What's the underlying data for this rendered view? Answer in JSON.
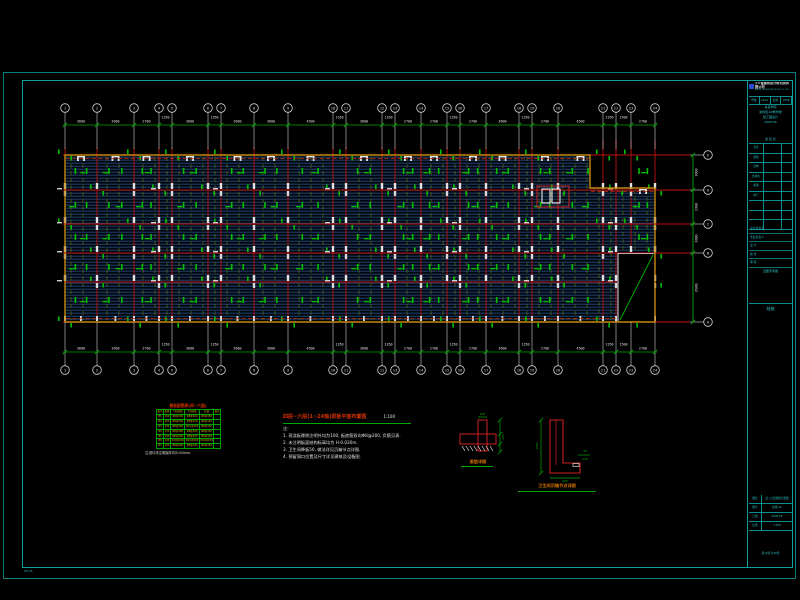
{
  "colors": {
    "frame": "#0b7d7d",
    "frame_inner": "#0f9f9f",
    "cad_red": "#c01010",
    "dim_green": "#00a800",
    "mark_green": "#00c000",
    "slab_blue": "#20426b",
    "edge_orange": "#c8860a",
    "text_white": "#e0e0e0",
    "tb_cyan": "#2cc5c5",
    "table_green": "#00a000",
    "table_yellow": "#d8a800",
    "title_red": "#d03000",
    "caption_orange": "#d07000"
  },
  "plan": {
    "left": 65,
    "top": 155,
    "right": 655,
    "bottom": 322,
    "notch_x": 590,
    "notch_y": 188,
    "mid_row": 282,
    "grid_x": [
      65,
      97,
      134,
      159,
      172,
      208,
      221,
      254,
      288,
      333,
      346,
      382,
      395,
      421,
      447,
      460,
      486,
      519,
      532,
      558,
      603,
      616,
      631,
      655
    ],
    "axis_rows": [
      155,
      190,
      224,
      253,
      322
    ],
    "top_labels": [
      "1",
      "2",
      "3",
      "4",
      "5",
      "6",
      "7",
      "8",
      "9",
      "10",
      "11",
      "12",
      "13",
      "14",
      "15",
      "16",
      "17",
      "18",
      "19",
      "20",
      "21",
      "22",
      "23",
      "24"
    ],
    "top_dims": [
      "3600",
      "3900",
      "2700",
      "1350",
      "3600",
      "1350",
      "3600",
      "3600",
      "4500",
      "1350",
      "3600",
      "1350",
      "2700",
      "2700",
      "1350",
      "2700",
      "3600",
      "1350",
      "2700",
      "4500",
      "1350",
      "1500",
      "2700"
    ],
    "right_labels": [
      "E",
      "D",
      "C",
      "B",
      "A"
    ],
    "right_dims": [
      "3600",
      "3300",
      "3000",
      "6900"
    ],
    "opening": {
      "x": 618,
      "y": 253,
      "w": 37,
      "h": 69
    },
    "stair": {
      "x": 537,
      "y": 186,
      "w": 32,
      "h": 21
    }
  },
  "slab_table": {
    "title": "楼板配筋表(四~六层)",
    "head": [
      "板号",
      "板厚",
      "X向底筋",
      "Y向底筋",
      "负筋",
      "备注"
    ],
    "rows": [
      [
        "B1",
        "100",
        "Φ8@200",
        "Φ8@200",
        "Φ8@150",
        ""
      ],
      [
        "B2",
        "100",
        "Φ8@200",
        "Φ8@200",
        "Φ8@150",
        ""
      ],
      [
        "B3",
        "100",
        "Φ8@200",
        "Φ10@200",
        "Φ8@150",
        ""
      ],
      [
        "B4",
        "110",
        "Φ8@180",
        "Φ8@180",
        "Φ8@150",
        ""
      ],
      [
        "B5",
        "100",
        "Φ8@200",
        "Φ8@200",
        "Φ8@150",
        ""
      ],
      [
        "B6",
        "120",
        "Φ10@200",
        "Φ10@200",
        "Φ10@150",
        ""
      ],
      [
        "B7",
        "100",
        "Φ8@200",
        "Φ8@200",
        "Φ8@150",
        ""
      ]
    ],
    "note": "注:图中未注明板厚均为100mm."
  },
  "notes": {
    "title": "四层~六层(1~24轴)梁板平面布置图",
    "scale": "1:100",
    "prefix": "注:",
    "lines": [
      "1. 现浇板厚除注明外均为100, 板底筋双向Φ8@200, 负筋见表.",
      "2. 未注明板面结构标高均为 H-0.030m.",
      "3. 卫生间降板50, 做法详见沉箱节点详图.",
      "4. 预留洞口位置及尺寸详见建筑及设备图."
    ]
  },
  "details": {
    "d1": {
      "caption": "梁垫详图",
      "dim_top": "240",
      "dim_right": "350"
    },
    "d2": {
      "caption": "卫生间沉箱节点详图",
      "dim_left": "1500",
      "dim_bottom": "600",
      "dim_side_a": "50",
      "dim_side_b": "120"
    }
  },
  "title_block": {
    "logo_main": "××省建筑设计研究院有限公司",
    "logo_sub": "ARCH. DESIGN INSTITUTE CO.,LTD",
    "cert_cells": [
      "甲级",
      "A102",
      "结施",
      "2008"
    ],
    "project_lines": [
      "某某学院",
      "新校区1#教学楼",
      "施工图设计",
      "2008.06"
    ],
    "sign_header": "会 签 栏",
    "sign_rows": [
      "专业",
      "建筑",
      "结构",
      "给排水",
      "暖通",
      "电气",
      "",
      "",
      ""
    ],
    "staff_rows": [
      "设计总负责",
      "专业负责人",
      "设 计",
      "校 对",
      "审 核"
    ],
    "stamp": "出图专用章",
    "discipline": "结施",
    "bottom_rows": [
      [
        "图名",
        "四~六层梁板平面图"
      ],
      [
        "图号",
        "结施-12"
      ],
      [
        "日期",
        "2008.06"
      ],
      [
        "比例",
        "1:100"
      ]
    ],
    "page_note": "第12张 共28张"
  },
  "corner_note": "08.06"
}
